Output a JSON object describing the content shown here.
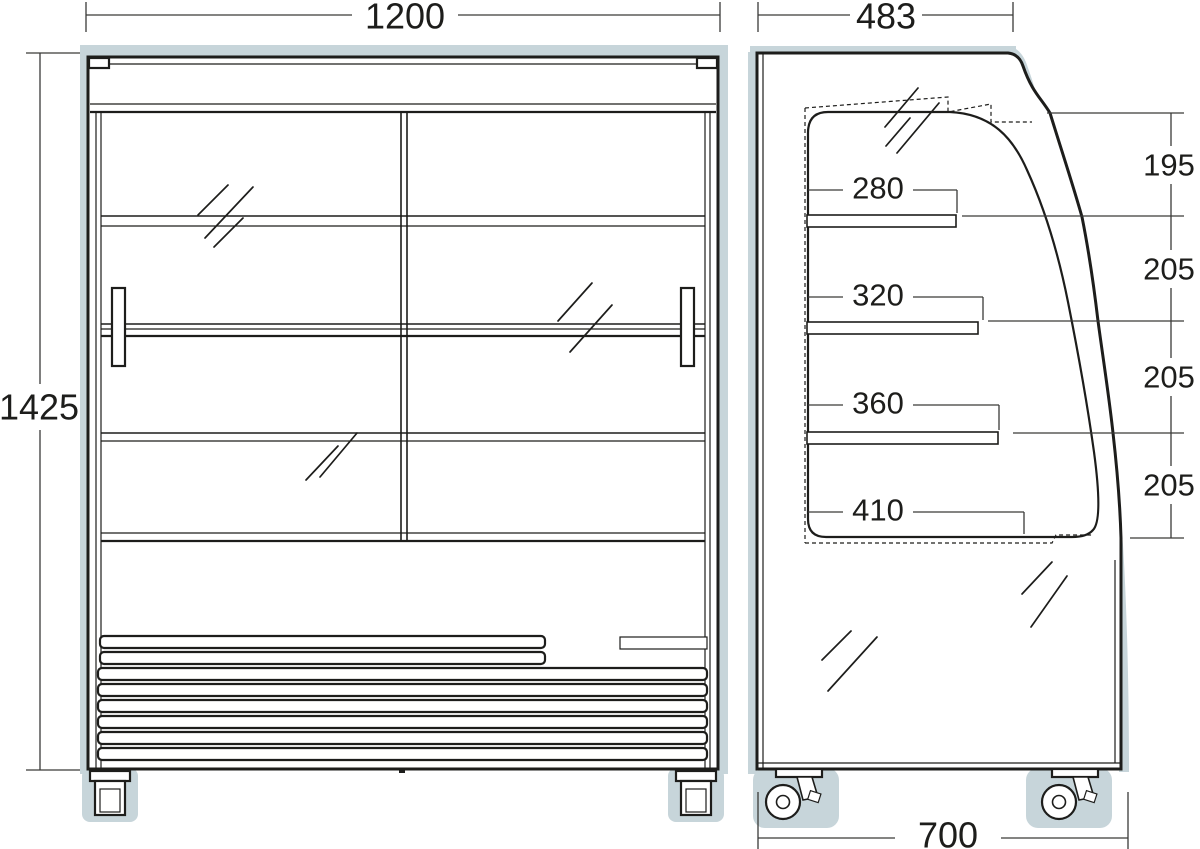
{
  "dims": {
    "front_width": "1200",
    "overall_height": "1425",
    "side_top_depth": "483",
    "side_bottom_depth": "700",
    "shelf_depths": [
      "280",
      "320",
      "360",
      "410"
    ],
    "level_spacings": [
      "195",
      "205",
      "205",
      "205"
    ]
  },
  "colors": {
    "line": "#1d1d1b",
    "dimension_line": "#3a3a38",
    "shadow_blue_gray": "#c7d5da",
    "background": "#ffffff"
  }
}
